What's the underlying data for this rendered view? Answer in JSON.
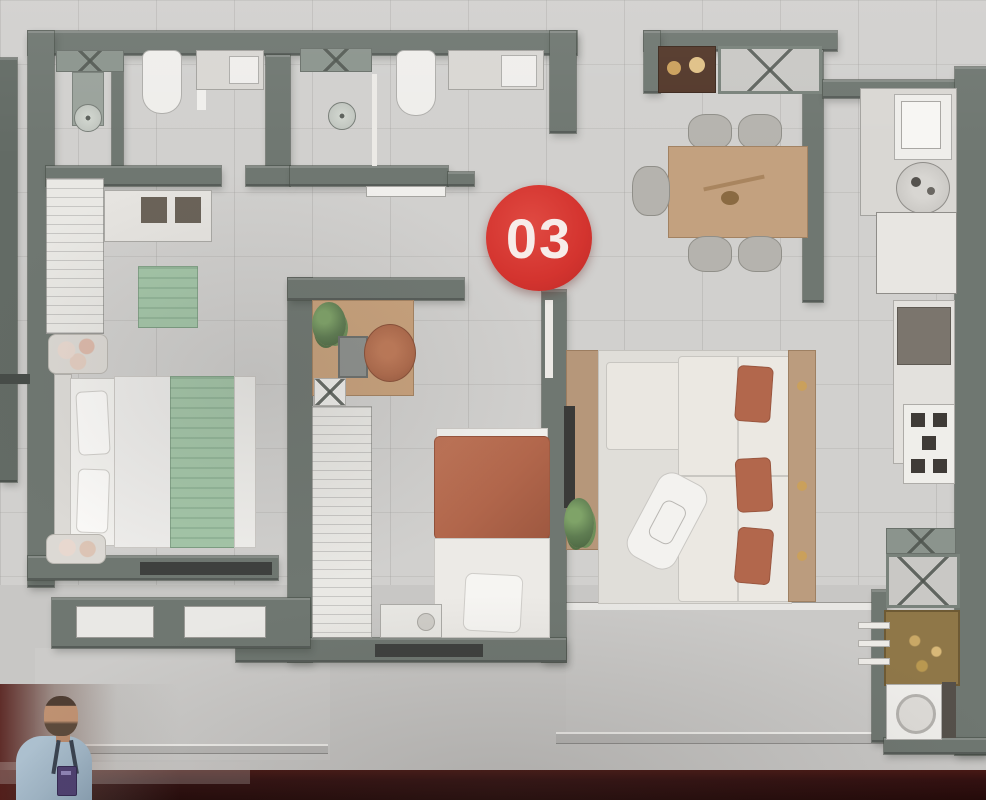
{
  "unit_badge": {
    "label": "03",
    "background": "#d4342f",
    "text_color": "#f7ece9"
  },
  "palette": {
    "floor_tile": "#d1d0ce",
    "wall_sage": "#6f7771",
    "exterior_concrete": "#c8c7c5",
    "bottom_strip_red": "#321010",
    "wood_table": "#c3a17f",
    "wood_dark_cabinet": "#53382a",
    "textile_green": "#a4c6a8",
    "textile_terracotta": "#b2674c",
    "sofa_cream": "#ebe8e2",
    "fixture_white": "#efeeeb",
    "presenter_shirt_blue": "#9fb4c4",
    "presenter_badge_purple": "#4e4070"
  },
  "rooms": [
    {
      "name": "bathroom-1"
    },
    {
      "name": "bathroom-2"
    },
    {
      "name": "master-bedroom"
    },
    {
      "name": "second-bedroom-office"
    },
    {
      "name": "living-room"
    },
    {
      "name": "dining-area"
    },
    {
      "name": "kitchen"
    },
    {
      "name": "service-area"
    },
    {
      "name": "balcony"
    }
  ],
  "presenter": {
    "visible": true
  }
}
